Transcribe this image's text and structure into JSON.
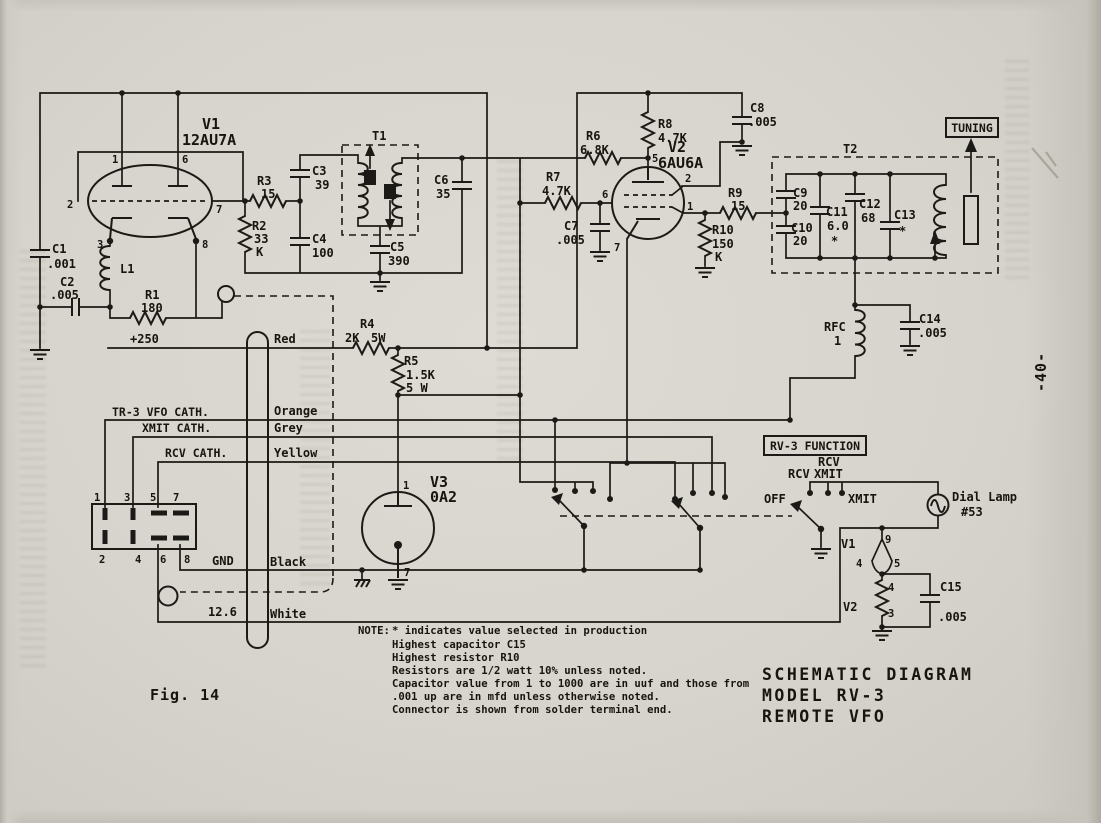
{
  "meta": {
    "fig_caption": "Fig. 14",
    "page_number": "-40-"
  },
  "title_block": {
    "l1": "SCHEMATIC DIAGRAM",
    "l2": "MODEL RV-3",
    "l3": "REMOTE VFO"
  },
  "note": {
    "head": "NOTE:",
    "lines": [
      "*  indicates value selected in production",
      "Highest capacitor C15",
      "Highest resistor R10",
      "Resistors are 1/2 watt 10% unless noted.",
      "Capacitor value from 1 to 1000 are in uuf and those from",
      ".001 up are in mfd unless otherwise noted.",
      "Connector is shown from solder terminal end."
    ]
  },
  "tubes": {
    "v1": {
      "ref": "V1",
      "type": "12AU7A"
    },
    "v2": {
      "ref": "V2",
      "type": "6AU6A"
    },
    "v3": {
      "ref": "V3",
      "type": "0A2"
    },
    "heater_v1_ref": "V1",
    "heater_v2_ref": "V2"
  },
  "pins": {
    "v1": [
      "1",
      "6",
      "2",
      "7",
      "3",
      "8"
    ],
    "v2": [
      "5",
      "6",
      "2",
      "1",
      "7"
    ],
    "v3": [
      "1",
      "7"
    ],
    "conn_top": [
      "1",
      "3",
      "5",
      "7"
    ],
    "conn_bot": [
      "2",
      "4",
      "6",
      "8"
    ],
    "heater_v1": [
      "9",
      "4",
      "5"
    ],
    "heater_v2": [
      "4",
      "3"
    ]
  },
  "c": {
    "c1": {
      "ref": "C1",
      "v": ".001"
    },
    "c2": {
      "ref": "C2",
      "v": ".005"
    },
    "c3": {
      "ref": "C3",
      "v": "39"
    },
    "c4": {
      "ref": "C4",
      "v": "100"
    },
    "c5": {
      "ref": "C5",
      "v": "390"
    },
    "c6": {
      "ref": "C6",
      "v": "35"
    },
    "c7": {
      "ref": "C7",
      "v": ".005"
    },
    "c8": {
      "ref": "C8",
      "v": ".005"
    },
    "c9": {
      "ref": "C9",
      "v": "20"
    },
    "c10": {
      "ref": "C10",
      "v": "20"
    },
    "c11": {
      "ref": "C11",
      "v": "6.0",
      "star": "*"
    },
    "c12": {
      "ref": "C12",
      "v": "68"
    },
    "c13": {
      "ref": "C13",
      "star": "*"
    },
    "c14": {
      "ref": "C14",
      "v": ".005"
    },
    "c15": {
      "ref": "C15",
      "v": ".005"
    },
    "r1": {
      "ref": "R1",
      "v": "180"
    },
    "r2": {
      "ref": "R2",
      "v1": "33",
      "v2": "K"
    },
    "r3": {
      "ref": "R3",
      "v": "15"
    },
    "r4": {
      "ref": "R4",
      "v1": "2K",
      "v2": "5W"
    },
    "r5": {
      "ref": "R5",
      "v1": "1.5K",
      "v2": "5 W"
    },
    "r6": {
      "ref": "R6",
      "v": "6.8K"
    },
    "r7": {
      "ref": "R7",
      "v": "4.7K"
    },
    "r8": {
      "ref": "R8",
      "v": "4.7K"
    },
    "r9": {
      "ref": "R9",
      "v": "15"
    },
    "r10": {
      "ref": "R10",
      "v1": "150",
      "v2": "K"
    },
    "l1": {
      "ref": "L1"
    },
    "t1": {
      "ref": "T1"
    },
    "t2": {
      "ref": "T2"
    },
    "rfc": {
      "ref": "RFC",
      "v": "1"
    }
  },
  "labels": {
    "tuning": "TUNING",
    "b_plus": "+250",
    "gnd": "GND",
    "heater_volts": "12.6",
    "vfo_cath": "TR-3 VFO CATH.",
    "xmit_cath": "XMIT CATH.",
    "rcv_cath": "RCV CATH."
  },
  "wire_colors": {
    "red": "Red",
    "orange": "Orange",
    "grey": "Grey",
    "yellow": "Yellow",
    "black": "Black",
    "white": "White"
  },
  "function_switch": {
    "box": "RV-3 FUNCTION",
    "off": "OFF",
    "rcv": "RCV",
    "rcv_xmit_1": "RCV",
    "rcv_xmit_2": "XMIT",
    "xmit": "XMIT"
  },
  "lamp": {
    "l1": "Dial Lamp",
    "l2": "#53"
  }
}
